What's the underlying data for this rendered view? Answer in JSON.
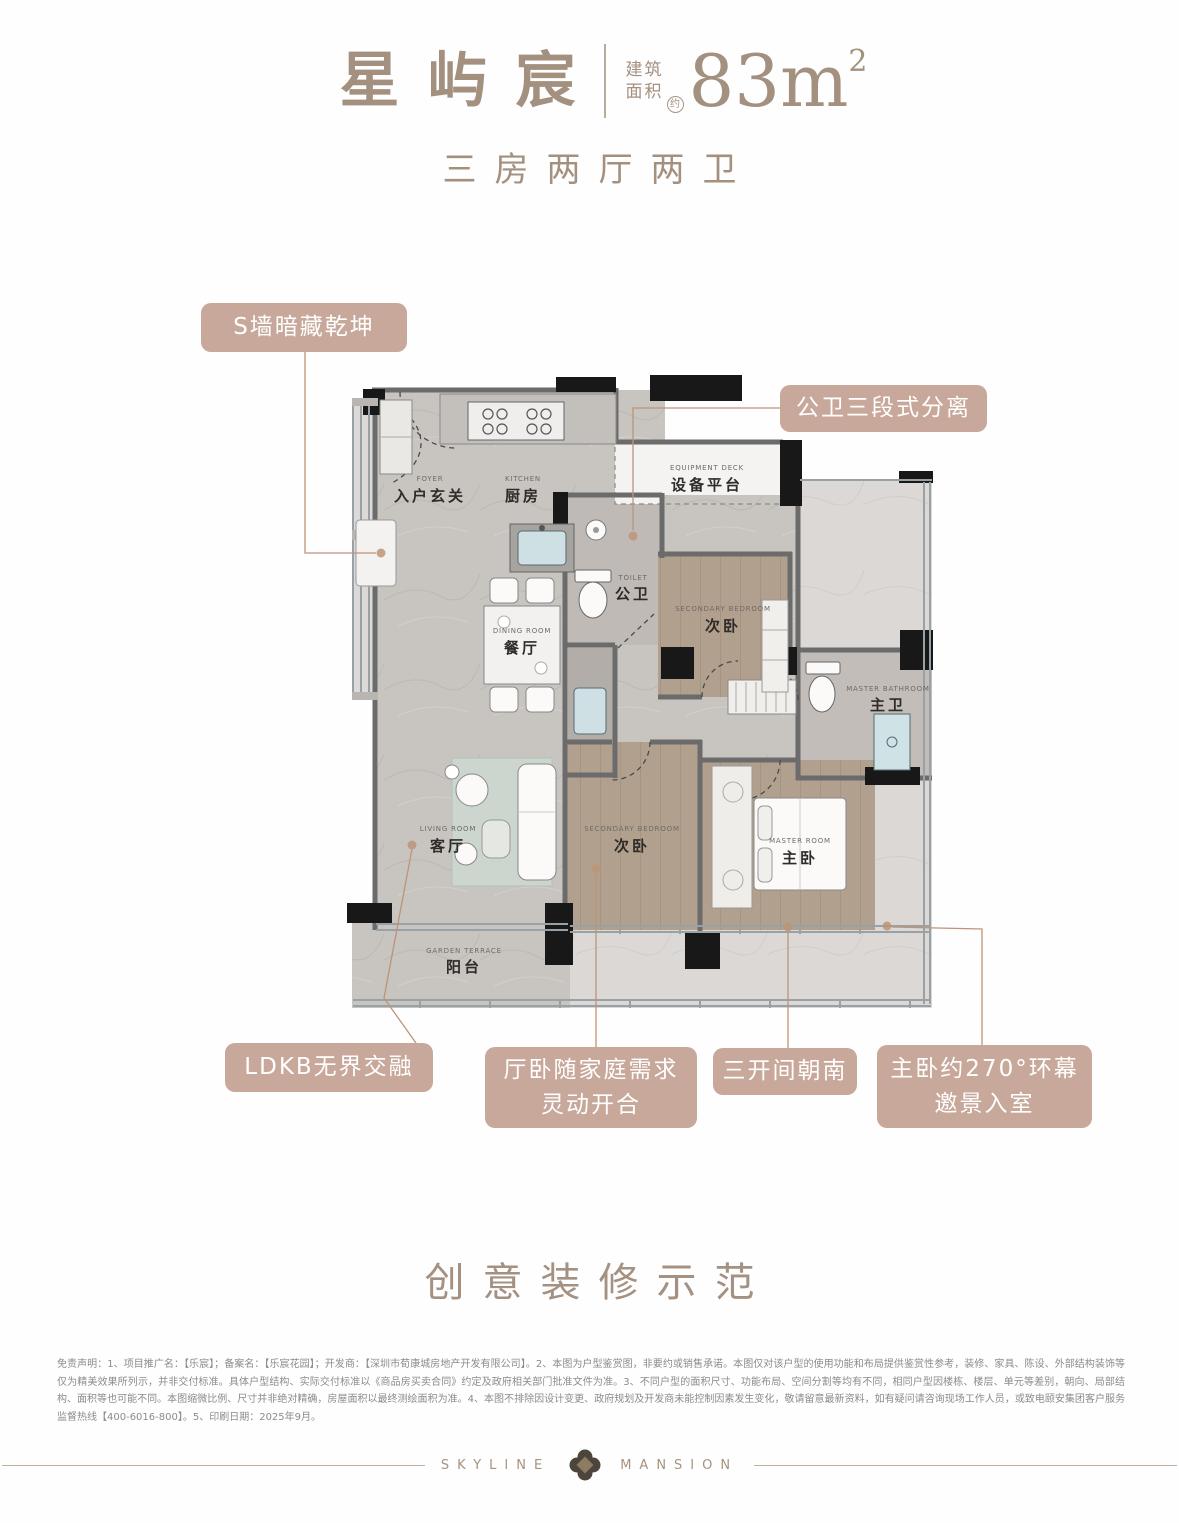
{
  "header": {
    "project_name": "星屿宸",
    "area_prefix_line1": "建筑",
    "area_prefix_line2": "面积",
    "area_approx": "约",
    "area_value": "83m",
    "area_exponent": "2",
    "subtitle": "三房两厅两卫"
  },
  "callouts": {
    "s_wall": {
      "label": "S墙暗藏乾坤"
    },
    "public_bath": {
      "label": "公卫三段式分离"
    },
    "ldkb": {
      "label": "LDKB无界交融"
    },
    "flex": {
      "line1": "厅卧随家庭需求",
      "line2": "灵动开合"
    },
    "south": {
      "label": "三开间朝南"
    },
    "master_view": {
      "line1": "主卧约270°环幕",
      "line2": "邀景入室"
    }
  },
  "rooms": {
    "foyer": {
      "cn": "入户玄关",
      "en": "FOYER"
    },
    "kitchen": {
      "cn": "厨房",
      "en": "KITCHEN"
    },
    "equipment_deck": {
      "cn": "设备平台",
      "en": "EQUIPMENT DECK"
    },
    "public_toilet": {
      "cn": "公卫",
      "en": "TOILET"
    },
    "secondary_bedroom_1": {
      "cn": "次卧",
      "en": "SECONDARY BEDROOM"
    },
    "dining": {
      "cn": "餐厅",
      "en": "DINING ROOM"
    },
    "living": {
      "cn": "客厅",
      "en": "LIVING ROOM"
    },
    "secondary_bedroom_2": {
      "cn": "次卧",
      "en": "SECONDARY BEDROOM"
    },
    "master_bedroom": {
      "cn": "主卧",
      "en": "MASTER ROOM"
    },
    "master_bathroom": {
      "cn": "主卫",
      "en": "MASTER BATHROOM"
    },
    "balcony": {
      "cn": "阳台",
      "en": "GARDEN TERRACE"
    }
  },
  "tagline": "创意装修示范",
  "disclaimer": "免责声明：1、项目推广名：【乐宸】；备案名：【乐宸花园】；开发商：【深圳市荀康城房地产开发有限公司】。2、本图为户型鉴赏图，非要约或销售承诺。本图仅对该户型的使用功能和布局提供鉴赏性参考，装修、家具、陈设、外部结构装饰等仅为精美效果所列示，并非交付标准。具体户型结构、实际交付标准以《商品房买卖合同》约定及政府相关部门批准文件为准。3、不同户型的面积尺寸、功能布局、空间分割等均有不同，相同户型因楼栋、楼层、单元等差别，朝向、局部结构、面积等也可能不同。本图缩微比例、尺寸并非绝对精确，房屋面积以最终测绘面积为准。4、本图不排除因设计变更、政府规划及开发商未能控制因素发生变化，敬请留意最新资料，如有疑问请咨询现场工作人员，或致电颐安集团客户服务监督热线【400-6016-800】。5、印刷日期：2025年9月。",
  "footer": {
    "brand_left": "SKYLINE",
    "brand_right": "MANSION"
  },
  "colors": {
    "accent_text": "#a3907f",
    "callout_bg": "#c8a89a",
    "wood_floor": "#b2a08f",
    "marble_floor": "#c8c4c0",
    "wall_dark": "#181818",
    "leader_line": "#bd9478"
  }
}
